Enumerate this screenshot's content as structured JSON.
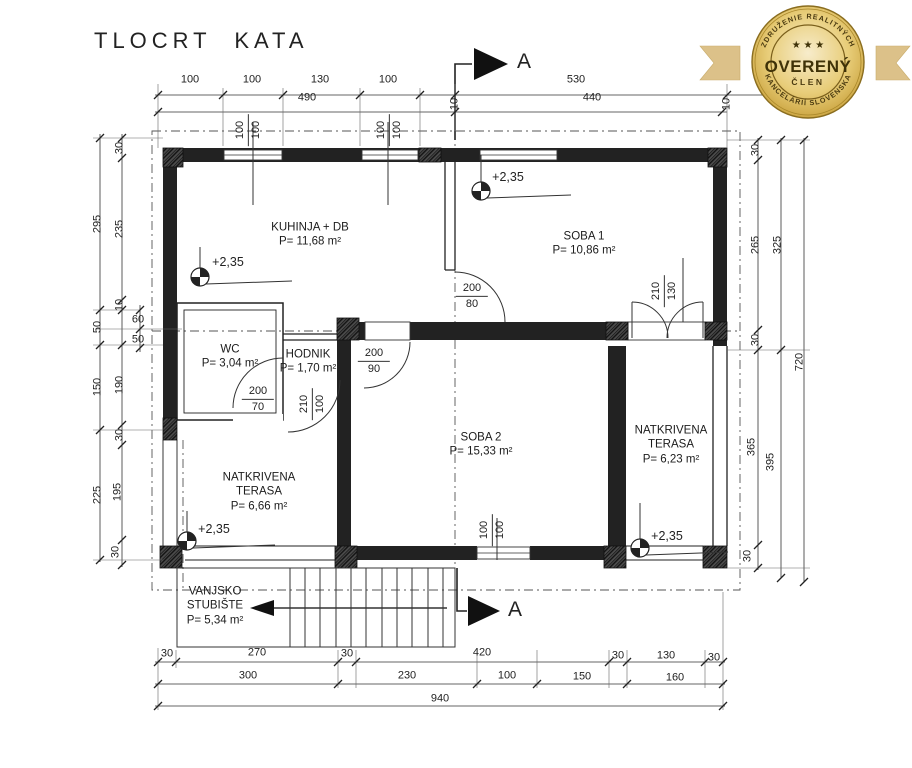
{
  "title": "TLOCRT KATA",
  "badge": {
    "arc_top": "ZDRUŽENIE REALITNÝCH",
    "arc_bottom": "KANCELÁRIÍ SLOVENSKA",
    "stars": "★ ★ ★",
    "main": "OVERENÝ",
    "sub": "ČLEN",
    "gold": "#cfa63b",
    "gold_light": "#f5e9c2",
    "ribbon": "#dcc189",
    "text_color": "#4a3a10"
  },
  "section": {
    "label": "A"
  },
  "rooms": [
    {
      "name": "KUHINJA + DB",
      "area": "P= 11,68 m²",
      "x": 310,
      "y": 235
    },
    {
      "name": "SOBA 1",
      "area": "P= 10,86 m²",
      "x": 584,
      "y": 244
    },
    {
      "name": "WC",
      "area": "P= 3,04 m²",
      "x": 230,
      "y": 357
    },
    {
      "name": "HODNIK",
      "area": "P= 1,70 m²",
      "x": 308,
      "y": 362
    },
    {
      "name": "SOBA 2",
      "area": "P= 15,33 m²",
      "x": 481,
      "y": 445
    },
    {
      "name": "NATKRIVENA TERASA",
      "area": "P= 6,23 m²",
      "x": 671,
      "y": 445
    },
    {
      "name": "NATKRIVENA TERASA",
      "area": "P= 6,66 m²",
      "x": 259,
      "y": 492
    },
    {
      "name": "VANJSKO STUBIŠTE",
      "area": "P= 5,34 m²",
      "x": 215,
      "y": 606
    }
  ],
  "elevations": [
    {
      "label": "+2,35",
      "x": 228,
      "y": 262
    },
    {
      "label": "+2,35",
      "x": 508,
      "y": 177
    },
    {
      "label": "+2,35",
      "x": 214,
      "y": 529
    },
    {
      "label": "+2,35",
      "x": 667,
      "y": 536
    }
  ],
  "openings": [
    {
      "w": "200",
      "h": "80",
      "x": 472,
      "y": 296,
      "rot": 0
    },
    {
      "w": "200",
      "h": "70",
      "x": 258,
      "y": 399,
      "rot": 0
    },
    {
      "w": "200",
      "h": "90",
      "x": 374,
      "y": 361,
      "rot": 0
    },
    {
      "w": "210",
      "h": "100",
      "x": 312,
      "y": 404,
      "rot": 1
    },
    {
      "w": "210",
      "h": "130",
      "x": 664,
      "y": 291,
      "rot": 1
    },
    {
      "w": "100",
      "h": "100",
      "x": 248,
      "y": 130,
      "rot": 1
    },
    {
      "w": "100",
      "h": "100",
      "x": 389,
      "y": 130,
      "rot": 1
    },
    {
      "w": "100",
      "h": "100",
      "x": 492,
      "y": 530,
      "rot": 1
    }
  ],
  "dimensions": {
    "top_row1": [
      {
        "t": "100",
        "x": 190,
        "y": 80
      },
      {
        "t": "100",
        "x": 252,
        "y": 80
      },
      {
        "t": "130",
        "x": 320,
        "y": 80
      },
      {
        "t": "100",
        "x": 388,
        "y": 80
      },
      {
        "t": "10",
        "x": 455,
        "y": 104,
        "rot": 1
      },
      {
        "t": "530",
        "x": 576,
        "y": 80
      },
      {
        "t": "10",
        "x": 727,
        "y": 104,
        "rot": 1
      }
    ],
    "top_row2": [
      {
        "t": "490",
        "x": 307,
        "y": 98
      },
      {
        "t": "440",
        "x": 592,
        "y": 98
      }
    ],
    "left_outer": [
      {
        "t": "295",
        "x": 98,
        "y": 224,
        "rot": 1
      },
      {
        "t": "50",
        "x": 98,
        "y": 327,
        "rot": 1
      },
      {
        "t": "150",
        "x": 98,
        "y": 387,
        "rot": 1
      },
      {
        "t": "225",
        "x": 98,
        "y": 495,
        "rot": 1
      }
    ],
    "left_inner": [
      {
        "t": "30",
        "x": 120,
        "y": 148,
        "rot": 1
      },
      {
        "t": "235",
        "x": 120,
        "y": 229,
        "rot": 1
      },
      {
        "t": "10",
        "x": 120,
        "y": 305,
        "rot": 1
      },
      {
        "t": "190",
        "x": 120,
        "y": 385,
        "rot": 1
      },
      {
        "t": "30",
        "x": 120,
        "y": 435,
        "rot": 1
      },
      {
        "t": "195",
        "x": 118,
        "y": 492,
        "rot": 1
      },
      {
        "t": "30",
        "x": 116,
        "y": 552,
        "rot": 1
      }
    ],
    "left_mini": [
      {
        "t": "60",
        "x": 138,
        "y": 320
      },
      {
        "t": "50",
        "x": 138,
        "y": 340
      }
    ],
    "right_inner": [
      {
        "t": "30",
        "x": 756,
        "y": 150,
        "rot": 1
      },
      {
        "t": "265",
        "x": 756,
        "y": 245,
        "rot": 1
      },
      {
        "t": "30",
        "x": 756,
        "y": 340,
        "rot": 1
      },
      {
        "t": "365",
        "x": 752,
        "y": 447,
        "rot": 1
      },
      {
        "t": "30",
        "x": 748,
        "y": 556,
        "rot": 1
      }
    ],
    "right_mid": [
      {
        "t": "325",
        "x": 778,
        "y": 245,
        "rot": 1
      },
      {
        "t": "395",
        "x": 771,
        "y": 462,
        "rot": 1
      }
    ],
    "right_outer": [
      {
        "t": "720",
        "x": 800,
        "y": 362,
        "rot": 1
      }
    ],
    "bottom_row1": [
      {
        "t": "30",
        "x": 167,
        "y": 654
      },
      {
        "t": "270",
        "x": 257,
        "y": 653
      },
      {
        "t": "30",
        "x": 347,
        "y": 654
      },
      {
        "t": "420",
        "x": 482,
        "y": 653
      },
      {
        "t": "30",
        "x": 618,
        "y": 656
      },
      {
        "t": "130",
        "x": 666,
        "y": 656
      },
      {
        "t": "30",
        "x": 714,
        "y": 658
      }
    ],
    "bottom_row2": [
      {
        "t": "300",
        "x": 248,
        "y": 676
      },
      {
        "t": "230",
        "x": 407,
        "y": 676
      },
      {
        "t": "100",
        "x": 507,
        "y": 676
      },
      {
        "t": "150",
        "x": 582,
        "y": 677
      },
      {
        "t": "160",
        "x": 675,
        "y": 678
      }
    ],
    "bottom_row3": [
      {
        "t": "940",
        "x": 440,
        "y": 699
      }
    ]
  }
}
